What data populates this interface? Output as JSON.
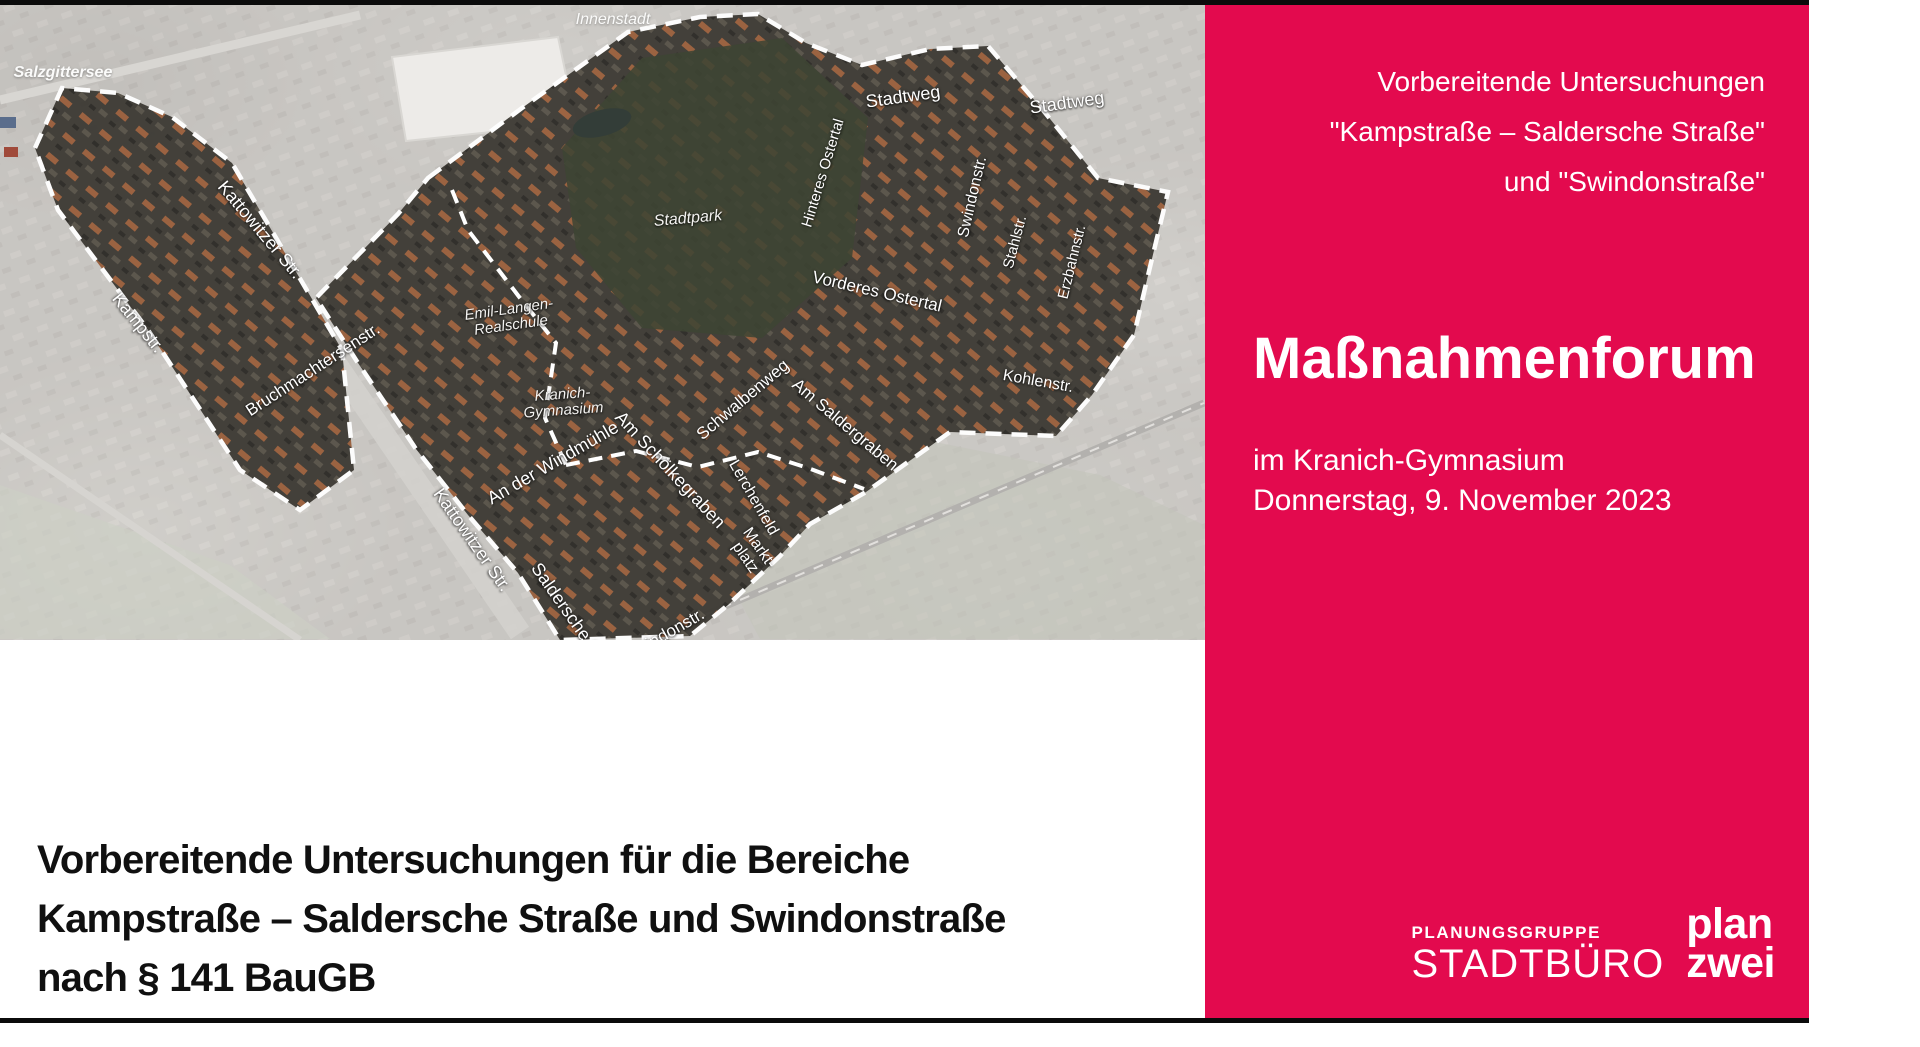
{
  "panel": {
    "bg_color": "#e30a4e",
    "text_color": "#ffffff",
    "header_line1": "Vorbereitende Untersuchungen",
    "header_line2": "\"Kampstraße – Saldersche Straße\"",
    "header_line3": "und \"Swindonstraße\"",
    "title": "Maßnahmenforum",
    "venue": "im Kranich-Gymnasium",
    "date": "Donnerstag, 9. November 2023"
  },
  "logos": {
    "stadtbuero_top": "PLANUNGSGRUPPE",
    "stadtbuero_bottom": "STADTBÜRO",
    "planzwei_line1": "plan",
    "planzwei_line2": "zwei"
  },
  "caption": {
    "line1": "Vorbereitende Untersuchungen für die Bereiche",
    "line2": "Kampstraße – Saldersche Straße und Swindonstraße",
    "line3": "nach § 141 BauGB"
  },
  "map": {
    "labels": {
      "salzgittersee": "Salzgittersee",
      "innenstadt": "Innenstadt",
      "stadtweg_w": "Stadtweg",
      "stadtweg_e": "Stadtweg",
      "hinteres_ostertal": "Hinteres Ostertal",
      "swindonstr_n": "Swindonstr.",
      "stahlstr": "Stahlstr.",
      "erzbahnstr": "Erzbahnstr.",
      "vorderes_ostertal": "Vorderes Ostertal",
      "kohlenstr": "Kohlenstr.",
      "stadtpark": "Stadtpark",
      "emil_langen_1": "Emil-Langen-",
      "emil_langen_2": "Realschule",
      "kranich_1": "Kranich-",
      "kranich_2": "Gymnasium",
      "an_der_windmuehle": "An der Windmühle",
      "am_schoelkegraben": "Am Schölkegraben",
      "schwalbenweg": "Schwalbenweg",
      "am_saldergraben": "Am Saldergraben",
      "lerchenfeld": "Lerchenfeld",
      "marktplatz_1": "Markt-",
      "marktplatz_2": "platz",
      "kattowitzer_n": "Kattowitzer Str.",
      "kampstr": "Kampstr.",
      "bruchmachtersenstr": "Bruchmachtersenstr.",
      "kattowitzer_s": "Kattowitzer Str.",
      "saldersche_str": "Saldersche Str.",
      "swindonstr_s": "Swindonstr."
    }
  }
}
